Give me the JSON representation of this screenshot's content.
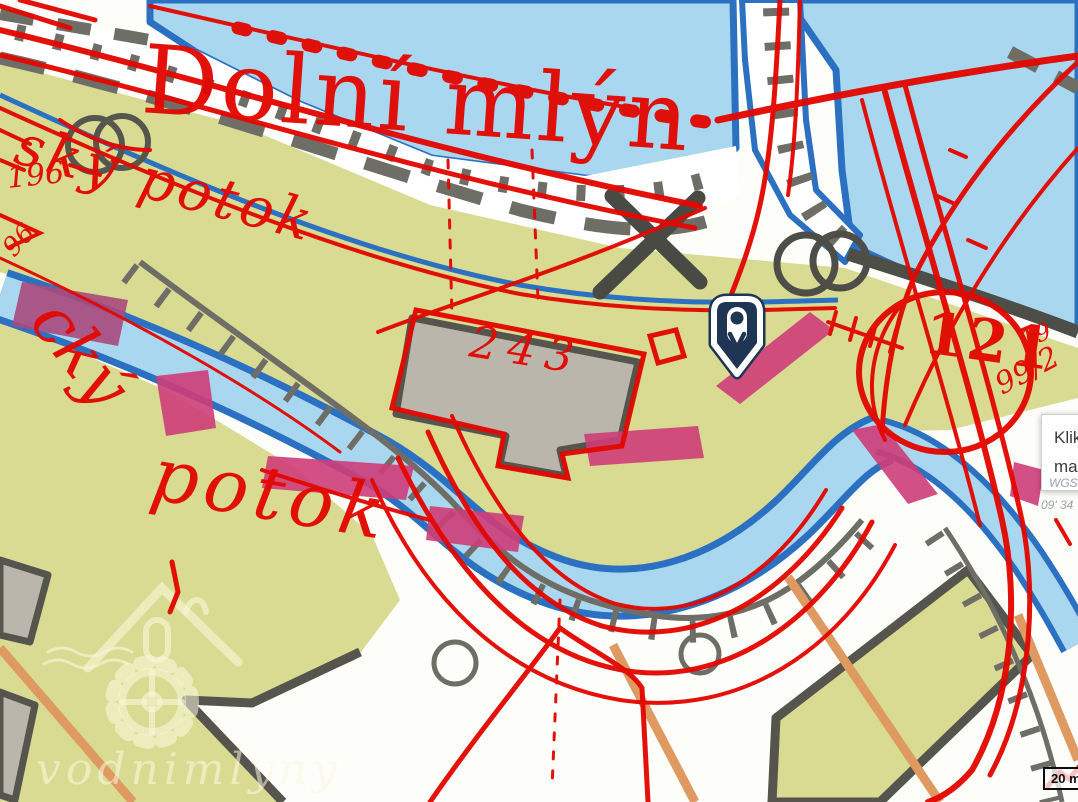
{
  "map": {
    "historic_overlay": {
      "place_name": "Dolní mlýn",
      "stream_name_top": "ský potok",
      "stream_name_left_upper": "cký",
      "stream_name_left_lower": "potok",
      "parcel_numbers": {
        "building": "243",
        "left_upper": "196",
        "left_lower": "96",
        "right_large": "121",
        "right_fraction": "99/2",
        "right_small": "19"
      }
    }
  },
  "tooltip": {
    "line1": "Klik",
    "line2": "ma"
  },
  "coordinate_labels": {
    "line1": "WGS",
    "line2": "09' 34"
  },
  "scale_bar": {
    "label": "20 m"
  },
  "watermark": {
    "text": "vodnimlyny"
  },
  "colors": {
    "overlay_red": "#e20800",
    "water_fill": "#aad7f0",
    "water_edge": "#2b70c1",
    "land_olive": "#d9db93",
    "building_gray": "#bab6ac",
    "historic_building_pink": "#ce3d79",
    "path_orange": "#de9a61",
    "marker_navy": "#1e3553"
  }
}
